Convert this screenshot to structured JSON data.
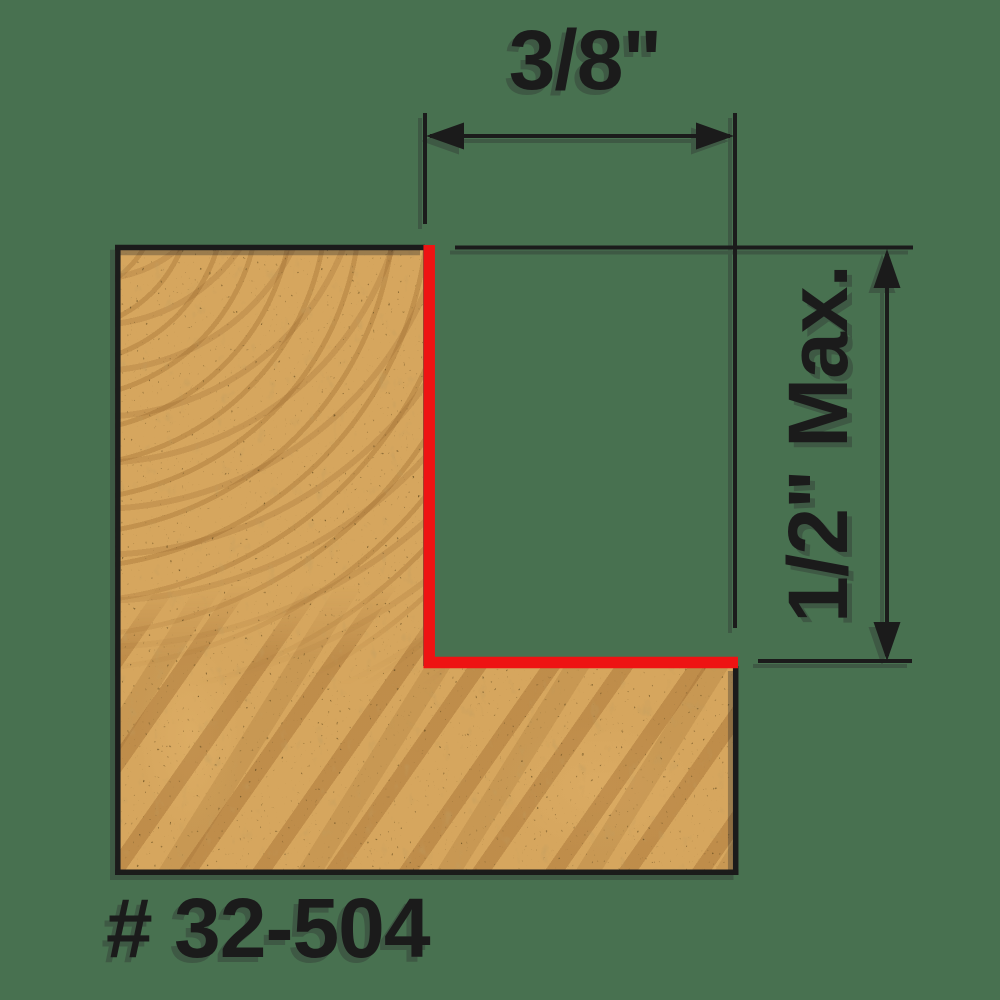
{
  "labels": {
    "width_dimension": "3/8\"",
    "depth_dimension": "1/2\" Max.",
    "part_number": "# 32-504"
  },
  "colors": {
    "background": "#487150",
    "ink": "#1B1B1B",
    "cut_highlight": "#EE1313",
    "wood_base": "#D6A65E"
  }
}
